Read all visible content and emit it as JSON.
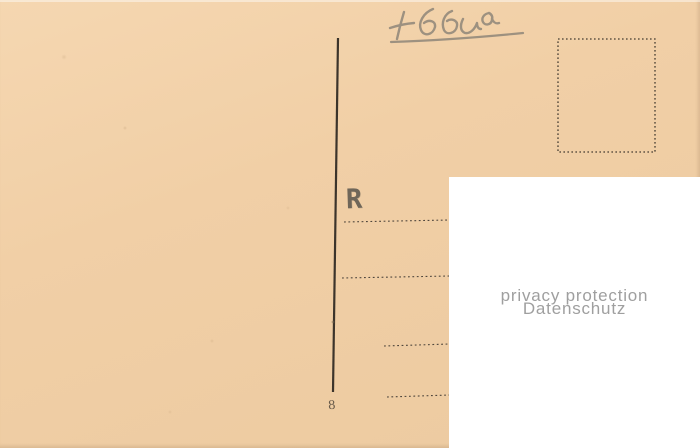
{
  "postcard": {
    "handwriting": {
      "transcription": "+ 6500",
      "color": "#8f8679"
    },
    "registration_mark": "R",
    "plate_number": "8",
    "colors": {
      "card": "#f1cfa6",
      "printed_ink": "#3c342b",
      "dashed_line": "#4f463c",
      "stamp_box_border": "#453c31"
    }
  },
  "privacy_overlay": {
    "line1": "privacy protection",
    "line2": "Datenschutz",
    "text_color": "#9f9f9f",
    "background": "#ffffff"
  }
}
